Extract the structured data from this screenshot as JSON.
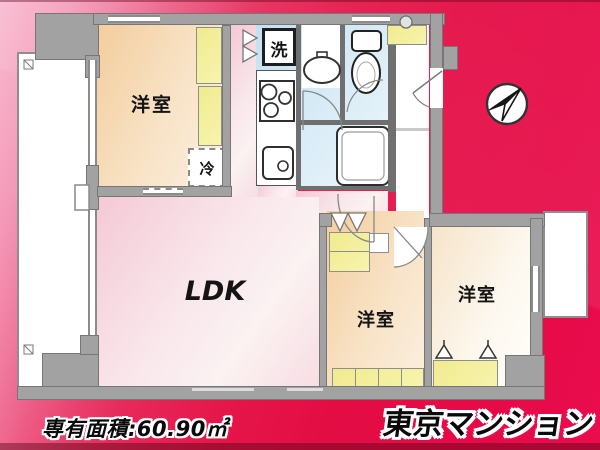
{
  "plan": {
    "rooms": {
      "bedroom_top_left": {
        "label": "洋室"
      },
      "ldk": {
        "label": "LDK"
      },
      "bedroom_bottom_left": {
        "label": "洋室"
      },
      "bedroom_right": {
        "label": "洋室"
      }
    },
    "fixtures": {
      "washer": {
        "label": "洗"
      },
      "fridge": {
        "label": "冷"
      }
    },
    "icons": {
      "compass": "compass-icon",
      "toilet": "toilet-icon",
      "bathtub": "bathtub-icon",
      "washbasin": "washbasin-icon",
      "stove": "stove-burners-icon",
      "sink": "kitchen-sink-icon",
      "hanger": "hanger-icon"
    }
  },
  "footer": {
    "area_label": "専有面積:60.90㎡",
    "brand": "東京マンション"
  },
  "colors": {
    "background_pink": "#f8abc6",
    "background_red": "#e5164a",
    "background_magenta": "#e8004c",
    "wall_gray": "#a2a2a2",
    "floor_peach": "#f3cd9d",
    "floor_pink": "#f4c9d6",
    "floor_blue": "#c3e0f2",
    "closet_yellow": "#f1ec8f",
    "balcony_white": "#ffffff"
  }
}
